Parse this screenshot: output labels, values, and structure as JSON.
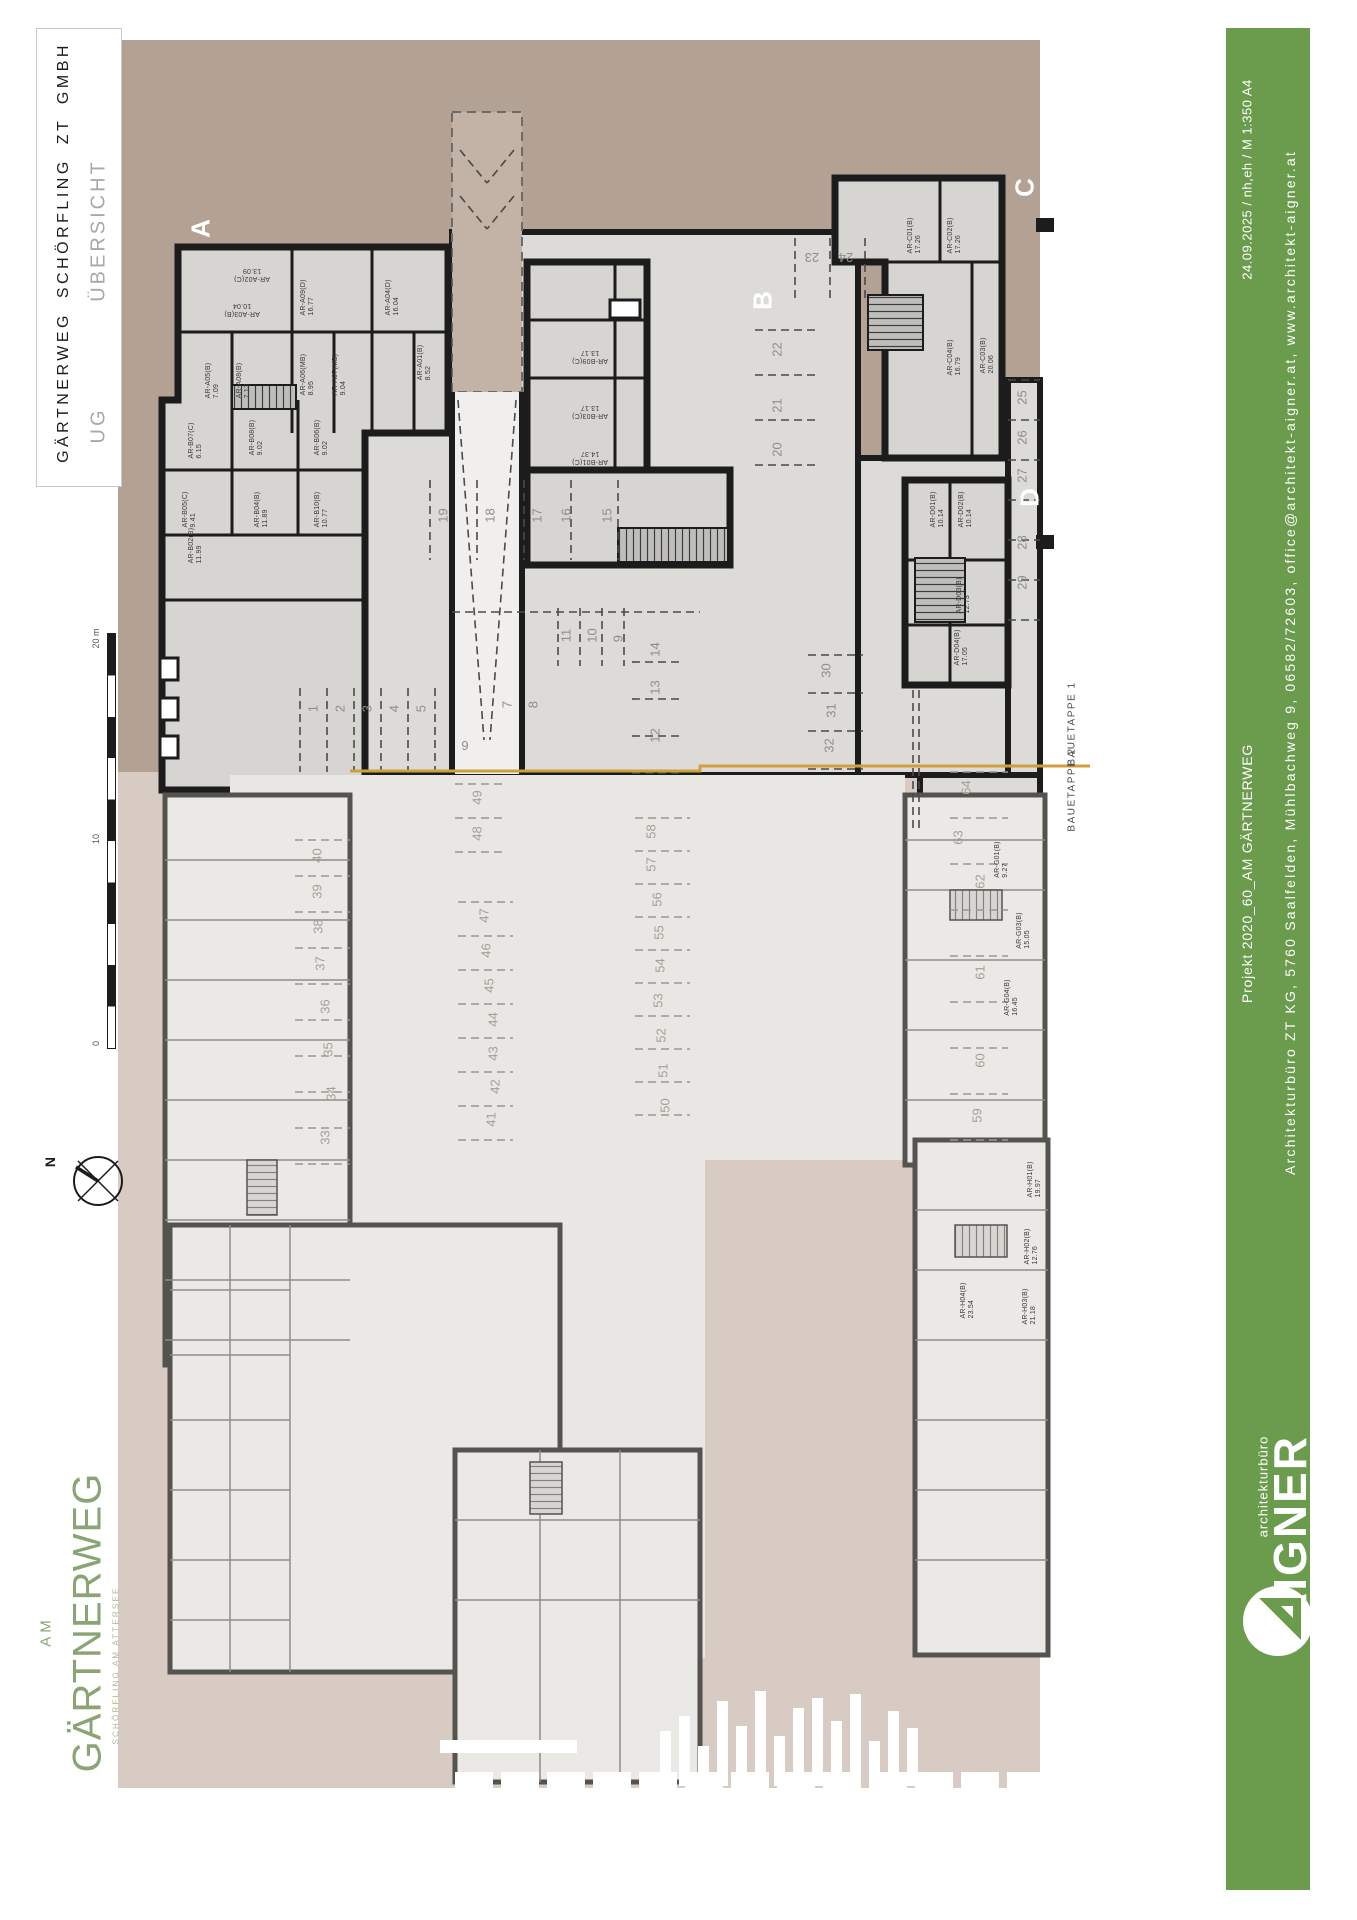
{
  "title_block": {
    "company": "GÄRTNERWEG SCHÖRFLING ZT GMBH",
    "level": "UG",
    "sheet": "ÜBERSICHT"
  },
  "green_bar": {
    "color": "#6b9b4c",
    "date_line": "24.09.2025 / nh,eh / M 1:350 A4",
    "project_line": "Projekt 2020_60_AM GÄRTNERWEG",
    "office_line": "Architekturbüro ZT KG, 5760 Saalfelden, Mühlbachweg 9, 06582/72603, office@architekt-aigner.at, www.architekt-aigner.at",
    "brand_small": "architekturbüro",
    "brand_name": "AIGNER",
    "brand_mark_icon": "aigner-a-circle-icon"
  },
  "margin": {
    "north_label": "N",
    "north_icon": "compass-circle-icon",
    "scale": {
      "label_top": "20 m",
      "label_mid": "10",
      "label_bottom": "0"
    },
    "site_logo": {
      "prefix": "AM",
      "name": "GÄRTNERWEG",
      "subtitle": "SCHÖRFLING AM ATTERSEE",
      "color": "#8ba474"
    }
  },
  "plan": {
    "colors": {
      "stage1_bg": "#b3a294",
      "stage2_bg": "#d8cbc3",
      "wall": "#1c1c1c",
      "room_fill": "#d6d5d2",
      "slab_fill": "#dcdbd8",
      "stage2_wall": "#55534f",
      "stage2_room": "#ebe9e6",
      "boundary_line": "#cf9f3e"
    },
    "sections": [
      {
        "label": "A",
        "x": 201,
        "y": 231
      },
      {
        "label": "B",
        "x": 763,
        "y": 303
      },
      {
        "label": "C",
        "x": 1025,
        "y": 190
      },
      {
        "label": "D",
        "x": 1030,
        "y": 500
      }
    ],
    "stage_labels": [
      {
        "label": "BAUETAPPE 1",
        "x": 1072,
        "y": 726
      },
      {
        "label": "BAUETAPPE 2",
        "x": 1072,
        "y": 792
      }
    ],
    "rooms_stage1": [
      {
        "label": "AR-A02(C)",
        "area": "13.09",
        "x": 252,
        "y": 275,
        "rot": 180
      },
      {
        "label": "AR-A03(B)",
        "area": "10.04",
        "x": 242,
        "y": 310,
        "rot": 180
      },
      {
        "label": "AR-A09(D)",
        "area": "16.77",
        "x": 308,
        "y": 300,
        "rot": -90
      },
      {
        "label": "AR-A04(D)",
        "area": "16.04",
        "x": 393,
        "y": 300,
        "rot": -90
      },
      {
        "label": "AR-A05(B)",
        "area": "7.09",
        "x": 213,
        "y": 383,
        "rot": -90
      },
      {
        "label": "AR-A08(B)",
        "area": "7.13",
        "x": 244,
        "y": 383,
        "rot": -90
      },
      {
        "label": "AR-A06(MB)",
        "area": "8.95",
        "x": 308,
        "y": 377,
        "rot": -90
      },
      {
        "label": "AR-A07(MB)",
        "area": "9.04",
        "x": 340,
        "y": 377,
        "rot": -90
      },
      {
        "label": "AR-A01(B)",
        "area": "8.52",
        "x": 425,
        "y": 365,
        "rot": -90
      },
      {
        "label": "AR-B07(C)",
        "area": "6.15",
        "x": 196,
        "y": 443,
        "rot": -90
      },
      {
        "label": "AR-B08(B)",
        "area": "9.02",
        "x": 257,
        "y": 440,
        "rot": -90
      },
      {
        "label": "AR-B06(B)",
        "area": "9.02",
        "x": 322,
        "y": 440,
        "rot": -90
      },
      {
        "label": "AR-B05(C)",
        "area": "9.41",
        "x": 190,
        "y": 512,
        "rot": -90
      },
      {
        "label": "AR-B04(B)",
        "area": "11.89",
        "x": 262,
        "y": 512,
        "rot": -90
      },
      {
        "label": "AR-B10(B)",
        "area": "10.77",
        "x": 322,
        "y": 512,
        "rot": -90
      },
      {
        "label": "AR-B02(B)",
        "area": "11.99",
        "x": 196,
        "y": 548,
        "rot": -90
      },
      {
        "label": "AR-B09(C)",
        "area": "13.17",
        "x": 590,
        "y": 357,
        "rot": 180
      },
      {
        "label": "AR-B03(C)",
        "area": "13.17",
        "x": 590,
        "y": 412,
        "rot": 180
      },
      {
        "label": "AR-B01(C)",
        "area": "14.37",
        "x": 590,
        "y": 458,
        "rot": 180
      },
      {
        "label": "AR-C01(B)",
        "area": "17.26",
        "x": 915,
        "y": 238,
        "rot": -90
      },
      {
        "label": "AR-C02(B)",
        "area": "17.26",
        "x": 955,
        "y": 238,
        "rot": -90
      },
      {
        "label": "AR-C04(B)",
        "area": "16.79",
        "x": 955,
        "y": 360,
        "rot": -90
      },
      {
        "label": "AR-C03(B)",
        "area": "20.06",
        "x": 988,
        "y": 358,
        "rot": -90
      },
      {
        "label": "AR-D01(B)",
        "area": "10.14",
        "x": 938,
        "y": 512,
        "rot": -90
      },
      {
        "label": "AR-D02(B)",
        "area": "10.14",
        "x": 966,
        "y": 512,
        "rot": -90
      },
      {
        "label": "AR-D03(B)",
        "area": "12.73",
        "x": 964,
        "y": 598,
        "rot": -90
      },
      {
        "label": "AR-D04(B)",
        "area": "17.05",
        "x": 962,
        "y": 650,
        "rot": -90
      }
    ],
    "rooms_stage2": [
      {
        "label": "AR-G01(B)",
        "area": "9.27",
        "x": 1002,
        "y": 862,
        "rot": -90
      },
      {
        "label": "AR-G03(B)",
        "area": "15.05",
        "x": 1024,
        "y": 933,
        "rot": -90
      },
      {
        "label": "AR-G04(B)",
        "area": "16.45",
        "x": 1012,
        "y": 1000,
        "rot": -90
      },
      {
        "label": "AR-H01(B)",
        "area": "19.97",
        "x": 1035,
        "y": 1182,
        "rot": -90
      },
      {
        "label": "AR-H02(B)",
        "area": "12.76",
        "x": 1032,
        "y": 1249,
        "rot": -90
      },
      {
        "label": "AR-H04(B)",
        "area": "23.54",
        "x": 968,
        "y": 1303,
        "rot": -90
      },
      {
        "label": "AR-H03(B)",
        "area": "21.18",
        "x": 1030,
        "y": 1309,
        "rot": -90
      }
    ],
    "parking_stage1": [
      {
        "n": "1",
        "x": 313,
        "y": 708,
        "rot": -90
      },
      {
        "n": "2",
        "x": 340,
        "y": 708,
        "rot": -90
      },
      {
        "n": "3",
        "x": 367,
        "y": 708,
        "rot": -90
      },
      {
        "n": "4",
        "x": 394,
        "y": 708,
        "rot": -90
      },
      {
        "n": "5",
        "x": 421,
        "y": 708,
        "rot": -90
      },
      {
        "n": "6",
        "x": 465,
        "y": 746,
        "rot": 180
      },
      {
        "n": "7",
        "x": 507,
        "y": 704,
        "rot": -90
      },
      {
        "n": "8",
        "x": 533,
        "y": 704,
        "rot": -90
      },
      {
        "n": "9",
        "x": 618,
        "y": 638,
        "rot": -90
      },
      {
        "n": "10",
        "x": 592,
        "y": 638,
        "rot": -90
      },
      {
        "n": "11",
        "x": 566,
        "y": 638,
        "rot": -90
      },
      {
        "n": "12",
        "x": 655,
        "y": 738,
        "rot": -90
      },
      {
        "n": "13",
        "x": 655,
        "y": 690,
        "rot": -90
      },
      {
        "n": "14",
        "x": 655,
        "y": 652,
        "rot": -90
      },
      {
        "n": "15",
        "x": 607,
        "y": 518,
        "rot": -90
      },
      {
        "n": "16",
        "x": 566,
        "y": 518,
        "rot": -90
      },
      {
        "n": "17",
        "x": 537,
        "y": 518,
        "rot": -90
      },
      {
        "n": "18",
        "x": 490,
        "y": 518,
        "rot": -90
      },
      {
        "n": "19",
        "x": 443,
        "y": 518,
        "rot": -90
      },
      {
        "n": "20",
        "x": 777,
        "y": 452,
        "rot": -90
      },
      {
        "n": "21",
        "x": 777,
        "y": 408,
        "rot": -90
      },
      {
        "n": "22",
        "x": 777,
        "y": 352,
        "rot": -90
      },
      {
        "n": "23",
        "x": 812,
        "y": 258,
        "rot": 180
      },
      {
        "n": "24",
        "x": 846,
        "y": 258,
        "rot": 180
      },
      {
        "n": "25",
        "x": 1022,
        "y": 400,
        "rot": -90
      },
      {
        "n": "26",
        "x": 1022,
        "y": 440,
        "rot": -90
      },
      {
        "n": "27",
        "x": 1022,
        "y": 478,
        "rot": -90
      },
      {
        "n": "28",
        "x": 1022,
        "y": 545,
        "rot": -90
      },
      {
        "n": "29",
        "x": 1022,
        "y": 585,
        "rot": -90
      },
      {
        "n": "30",
        "x": 826,
        "y": 673,
        "rot": -90
      },
      {
        "n": "31",
        "x": 831,
        "y": 713,
        "rot": -90
      },
      {
        "n": "32",
        "x": 829,
        "y": 748,
        "rot": -90
      }
    ],
    "parking_stage2": [
      {
        "n": "33",
        "x": 325,
        "y": 1140,
        "rot": -90
      },
      {
        "n": "34",
        "x": 331,
        "y": 1096,
        "rot": -90
      },
      {
        "n": "35",
        "x": 328,
        "y": 1052,
        "rot": -90
      },
      {
        "n": "36",
        "x": 325,
        "y": 1009,
        "rot": -90
      },
      {
        "n": "37",
        "x": 320,
        "y": 966,
        "rot": -90
      },
      {
        "n": "38",
        "x": 318,
        "y": 929,
        "rot": -90
      },
      {
        "n": "39",
        "x": 317,
        "y": 894,
        "rot": -90
      },
      {
        "n": "40",
        "x": 317,
        "y": 858,
        "rot": -90
      },
      {
        "n": "41",
        "x": 491,
        "y": 1122,
        "rot": -90
      },
      {
        "n": "42",
        "x": 495,
        "y": 1089,
        "rot": -90
      },
      {
        "n": "43",
        "x": 493,
        "y": 1056,
        "rot": -90
      },
      {
        "n": "44",
        "x": 493,
        "y": 1022,
        "rot": -90
      },
      {
        "n": "45",
        "x": 489,
        "y": 988,
        "rot": -90
      },
      {
        "n": "46",
        "x": 486,
        "y": 953,
        "rot": -90
      },
      {
        "n": "47",
        "x": 484,
        "y": 918,
        "rot": -90
      },
      {
        "n": "48",
        "x": 477,
        "y": 836,
        "rot": -90
      },
      {
        "n": "49",
        "x": 477,
        "y": 800,
        "rot": -90
      },
      {
        "n": "50",
        "x": 665,
        "y": 1108,
        "rot": -90
      },
      {
        "n": "51",
        "x": 663,
        "y": 1073,
        "rot": -90
      },
      {
        "n": "52",
        "x": 661,
        "y": 1038,
        "rot": -90
      },
      {
        "n": "53",
        "x": 658,
        "y": 1003,
        "rot": -90
      },
      {
        "n": "54",
        "x": 660,
        "y": 968,
        "rot": -90
      },
      {
        "n": "55",
        "x": 659,
        "y": 935,
        "rot": -90
      },
      {
        "n": "56",
        "x": 657,
        "y": 902,
        "rot": -90
      },
      {
        "n": "57",
        "x": 651,
        "y": 867,
        "rot": -90
      },
      {
        "n": "58",
        "x": 651,
        "y": 834,
        "rot": -90
      },
      {
        "n": "59",
        "x": 977,
        "y": 1118,
        "rot": -90
      },
      {
        "n": "60",
        "x": 980,
        "y": 1063,
        "rot": -90
      },
      {
        "n": "61",
        "x": 980,
        "y": 975,
        "rot": -90
      },
      {
        "n": "62",
        "x": 980,
        "y": 884,
        "rot": -90
      },
      {
        "n": "63",
        "x": 958,
        "y": 840,
        "rot": -90
      },
      {
        "n": "64",
        "x": 966,
        "y": 790,
        "rot": -90
      }
    ]
  }
}
